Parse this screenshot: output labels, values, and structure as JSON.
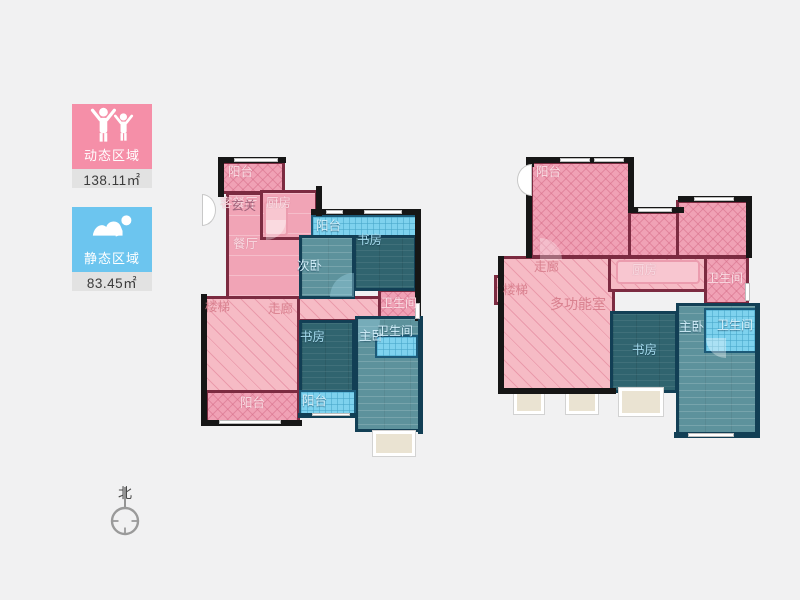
{
  "legend": {
    "dynamic": {
      "label": "动态区域",
      "area": "138.11㎡",
      "color": "#f58fa8",
      "icon": "people-arms-up-icon"
    },
    "static": {
      "label": "静态区域",
      "area": "83.45㎡",
      "color": "#6cc5ef",
      "icon": "person-sleeping-icon"
    }
  },
  "compass": {
    "north_label": "北"
  },
  "colors": {
    "dynamic_fill": "#f0a1b5",
    "dynamic_wall": "#7c2b41",
    "static_fill_dark": "#30646f",
    "static_fill_mid": "#5d929c",
    "static_fill_light": "#7ed2ee",
    "static_wall": "#123f55",
    "outer_wall": "#161616",
    "background": "#f1f1f2"
  },
  "floorplans": {
    "left": {
      "rooms": [
        {
          "id": "balcony-top",
          "label": "阳台",
          "zone": "dynamic"
        },
        {
          "id": "living-dining",
          "label": "客餐厅",
          "zone": "dynamic"
        },
        {
          "id": "foyer",
          "label": "玄关",
          "zone": "dynamic"
        },
        {
          "id": "kitchen",
          "label": "厨房",
          "zone": "dynamic"
        },
        {
          "id": "dining",
          "label": "餐厅",
          "zone": "dynamic"
        },
        {
          "id": "balcony-north",
          "label": "阳台",
          "zone": "static"
        },
        {
          "id": "study-north",
          "label": "书房",
          "zone": "static"
        },
        {
          "id": "bedroom-second",
          "label": "次卧",
          "zone": "static"
        },
        {
          "id": "bathroom-mid",
          "label": "卫生间",
          "zone": "dynamic"
        },
        {
          "id": "stairs",
          "label": "楼梯",
          "zone": "dynamic"
        },
        {
          "id": "corridor",
          "label": "走廊",
          "zone": "dynamic"
        },
        {
          "id": "study-south",
          "label": "书房",
          "zone": "static"
        },
        {
          "id": "bedroom-master",
          "label": "主卧",
          "zone": "static"
        },
        {
          "id": "bathroom-master",
          "label": "卫生间",
          "zone": "static"
        },
        {
          "id": "balcony-south-pink",
          "label": "阳台",
          "zone": "dynamic"
        },
        {
          "id": "balcony-south-blue",
          "label": "阳台",
          "zone": "static"
        }
      ]
    },
    "right": {
      "rooms": [
        {
          "id": "terrace",
          "label": "阳台",
          "zone": "dynamic"
        },
        {
          "id": "corridor",
          "label": "走廊",
          "zone": "dynamic"
        },
        {
          "id": "kitchen",
          "label": "厨房",
          "zone": "dynamic"
        },
        {
          "id": "bathroom-north",
          "label": "卫生间",
          "zone": "dynamic"
        },
        {
          "id": "stairs",
          "label": "楼梯",
          "zone": "dynamic"
        },
        {
          "id": "multi-function",
          "label": "多功能室",
          "zone": "dynamic"
        },
        {
          "id": "study",
          "label": "书房",
          "zone": "static"
        },
        {
          "id": "bedroom-master",
          "label": "主卧",
          "zone": "static"
        },
        {
          "id": "bathroom-master",
          "label": "卫生间",
          "zone": "static"
        }
      ]
    }
  }
}
